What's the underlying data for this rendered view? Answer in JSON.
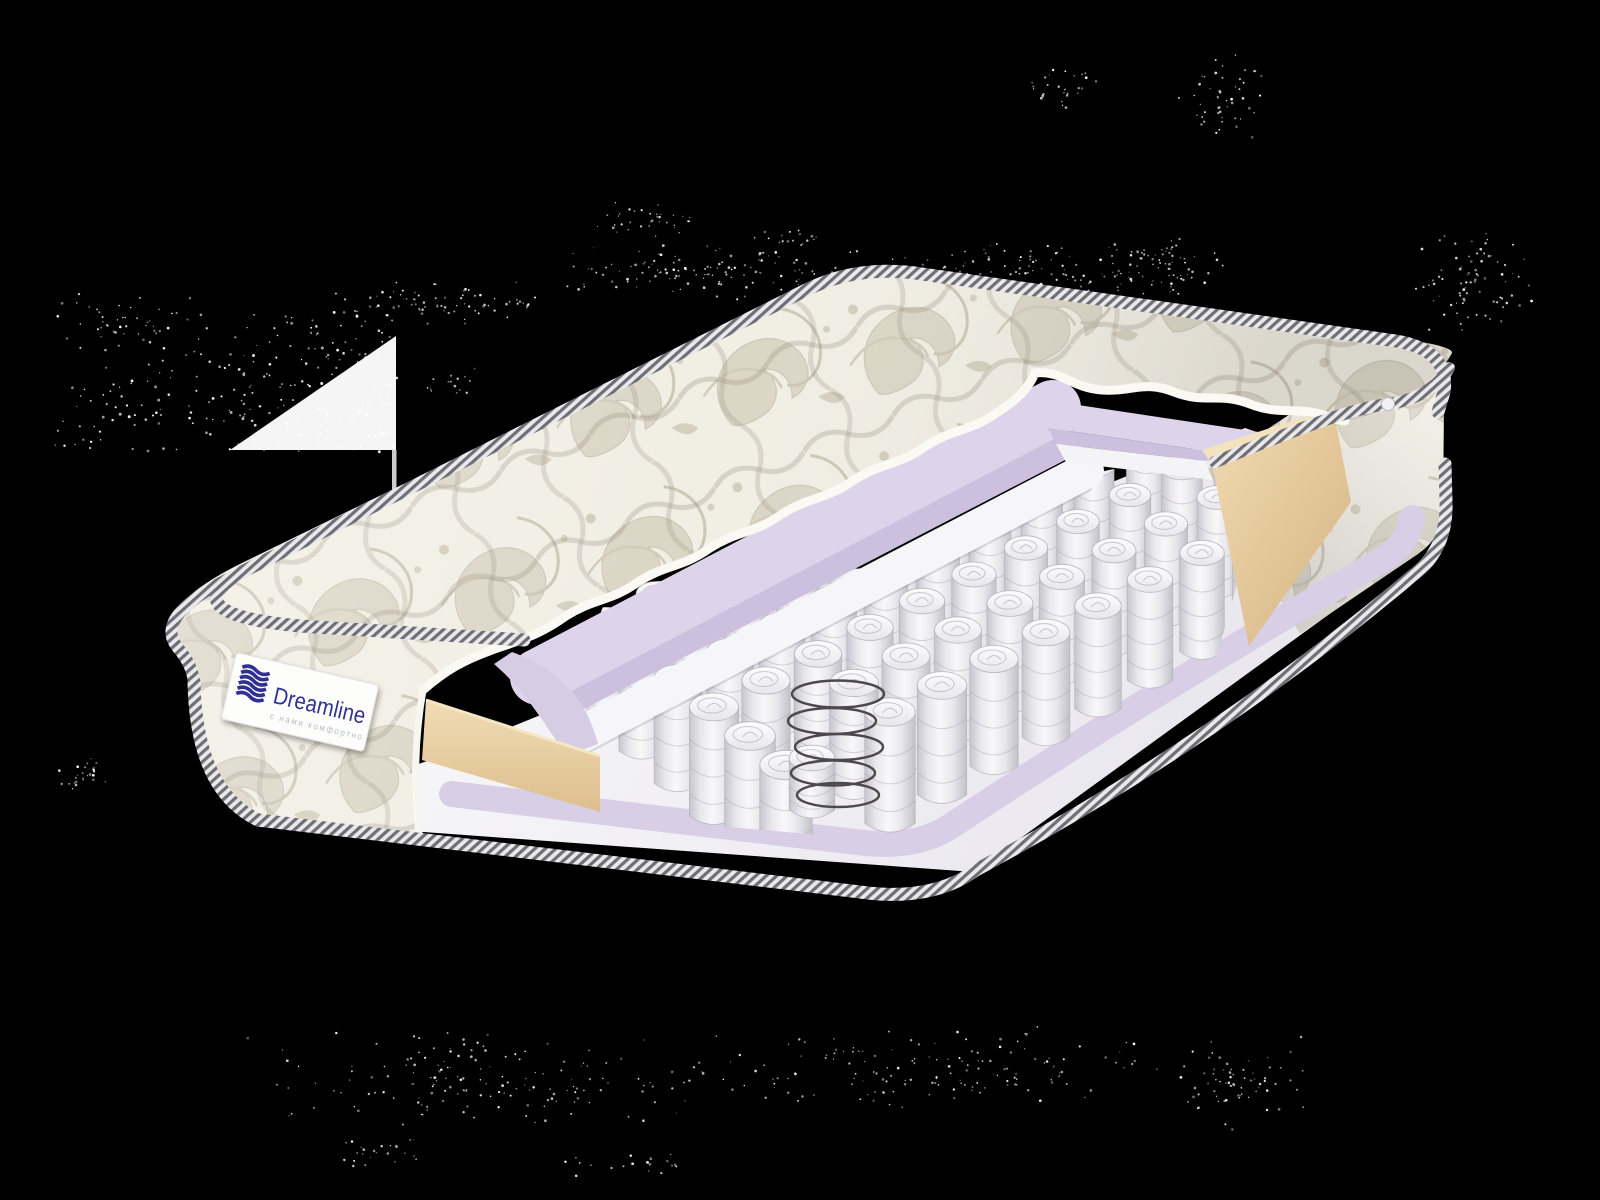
{
  "page": {
    "type": "product-image",
    "background_color": "#000000",
    "subject": "mattress cutaway render"
  },
  "brand_label": {
    "brand": "Dreamline",
    "tagline": "с нами комфортно",
    "brand_color": "#2e3192",
    "tagline_color": "#b5bbc9",
    "label_background": "#fdfdfc",
    "logo_icon": "dreamline-waves-icon"
  },
  "colors": {
    "fabric_base": "#f1eee4",
    "fabric_motif": "#dbd6c6",
    "fabric_motif_outline": "#c9c3b1",
    "tape_dark": "#6f6e74",
    "tape_light": "#e9e9eb",
    "foam_lavender_top": "#ddd4eb",
    "foam_lavender_face": "#cdc0de",
    "foam_lavender_border": "#d8cee6",
    "felt_white": "#f6f5f8",
    "foam_beige": "#eed7ab",
    "foam_beige_dark": "#ddbe8e",
    "spring_white": "#f7f6f8",
    "spring_shade": "#c9c8cf",
    "spring_outline": "#b6b5bd",
    "wire_coil": "#4b4949",
    "base_floor": "#f1f0f4",
    "noise_speckle": "#ffffff"
  }
}
